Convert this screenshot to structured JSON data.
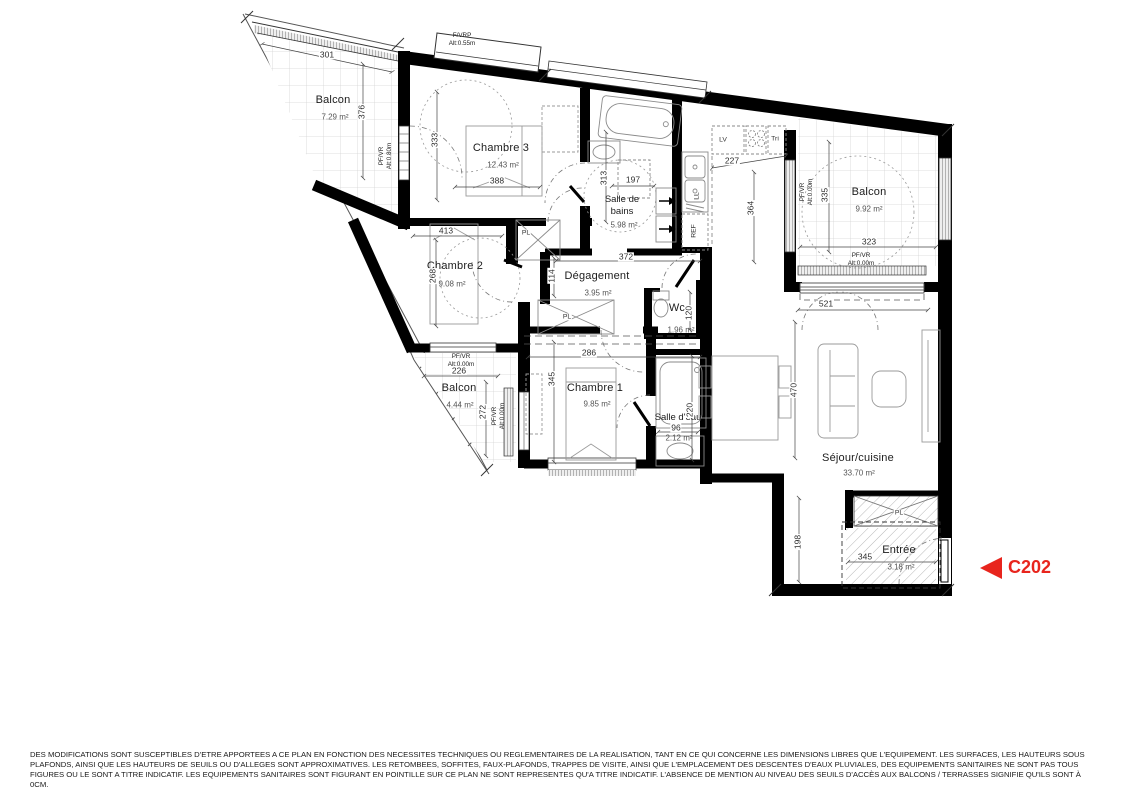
{
  "unit": {
    "code": "C202",
    "accent_color": "#e8251d"
  },
  "rooms": {
    "balcon_tl": {
      "name": "Balcon",
      "area": "7.29 m²"
    },
    "chambre3": {
      "name": "Chambre 3",
      "area": "12.43 m²"
    },
    "sdb": {
      "name_l1": "Salle de",
      "name_l2": "bains",
      "area": "5.98 m²"
    },
    "balcon_r": {
      "name": "Balcon",
      "area": "9.92 m²"
    },
    "chambre2": {
      "name": "Chambre 2",
      "area": "9.08 m²"
    },
    "degagement": {
      "name": "Dégagement",
      "area": "3.95 m²"
    },
    "wc": {
      "name": "Wc",
      "area": "1.96 m²"
    },
    "chambre1": {
      "name": "Chambre 1",
      "area": "9.85 m²"
    },
    "balcon_bl": {
      "name": "Balcon",
      "area": "4.44 m²"
    },
    "salle_eau": {
      "name": "Salle d'eau",
      "area": "2.12 m²"
    },
    "sejour": {
      "name": "Séjour/cuisine",
      "area": "33.70 m²"
    },
    "entree": {
      "name": "Entrée",
      "area": "3.18 m²"
    }
  },
  "dims": {
    "d301": "301",
    "d376": "376",
    "d333": "333",
    "d388": "388",
    "d413": "413",
    "d268": "268",
    "d313": "313",
    "d197": "197",
    "d372": "372",
    "d227": "227",
    "d364": "364",
    "d335": "335",
    "d323": "323",
    "d114": "114",
    "d286": "286",
    "d120": "120",
    "d345": "345",
    "d226": "226",
    "d272": "272",
    "d220": "220",
    "d96": "96",
    "d521": "521",
    "d470": "470",
    "d198": "198"
  },
  "fixtures": {
    "pl": "PL",
    "lv": "LV",
    "tri": "Tri",
    "ref": "REF",
    "ll": "LL"
  },
  "notes": {
    "fvrp": "F/VRP",
    "fvrp_alt": "Alt:0.55m",
    "pfvr": "PF/VR",
    "alt080": "Alt:0.80m",
    "alt000": "Alt:0.00m"
  },
  "disclaimer": "DES MODIFICATIONS SONT SUSCEPTIBLES D'ETRE APPORTEES A CE PLAN EN FONCTION DES NECESSITES TECHNIQUES OU REGLEMENTAIRES DE LA REALISATION, TANT EN CE QUI CONCERNE LES DIMENSIONS LIBRES QUE L'EQUIPEMENT. LES SURFACES, LES HAUTEURS SOUS PLAFONDS, AINSI QUE LES HAUTEURS DE SEUILS OU D'ALLEGES SONT APPROXIMATIVES. LES RETOMBEES, SOFFITES, FAUX-PLAFONDS, TRAPPES DE VISITE, AINSI QUE L'EMPLACEMENT DES DESCENTES D'EAUX PLUVIALES, DES EQUIPEMENTS SANITAIRES NE SONT PAS TOUS FIGURES OU LE SONT A TITRE INDICATIF. LES EQUIPEMENTS SANITAIRES SONT FIGURANT EN POINTILLE SUR CE PLAN NE SONT REPRESENTES QU'A TITRE INDICATIF. L'ABSENCE DE MENTION AU NIVEAU DES SEUILS D'ACCÈS AUX BALCONS / TERRASSES SIGNIFIE QU'ILS SONT À 0CM."
}
